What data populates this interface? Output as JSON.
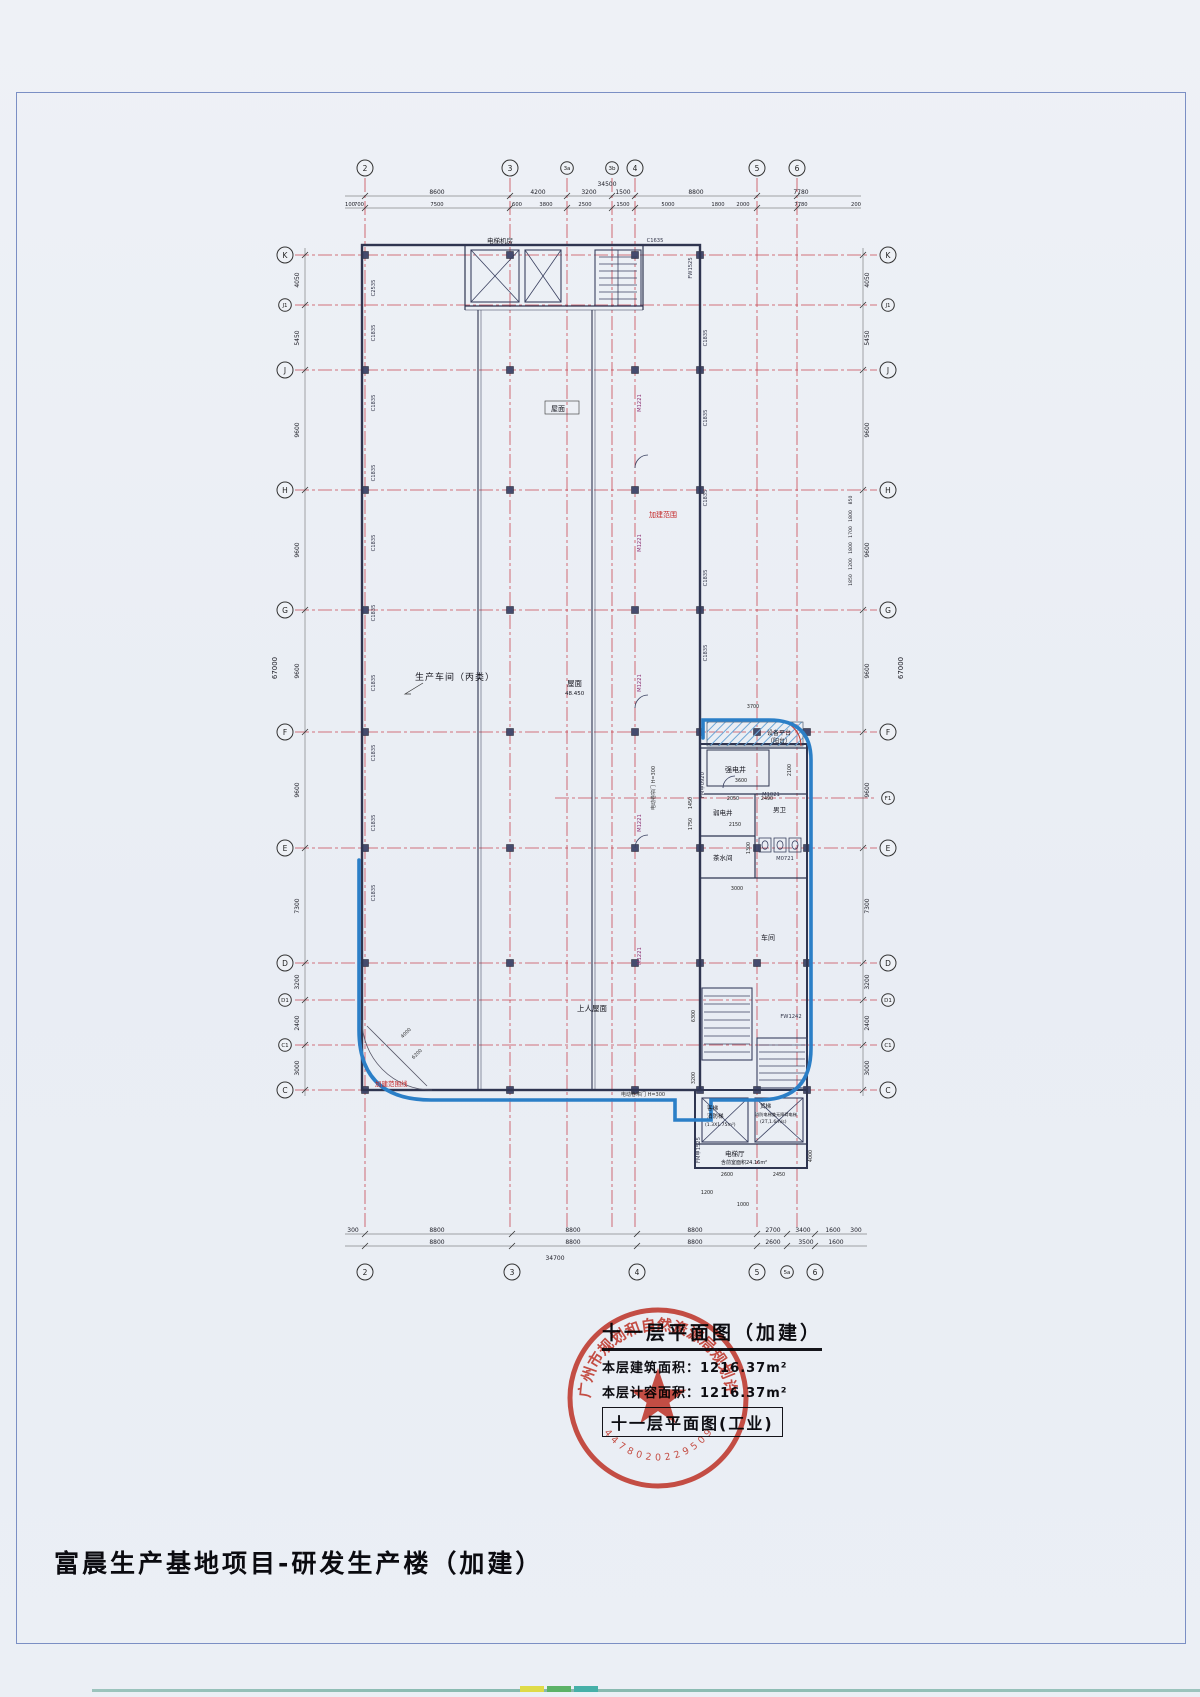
{
  "page": {
    "project_title": "富晨生产基地项目-研发生产楼（加建）"
  },
  "titleblock": {
    "drawing_title": "十一层平面图（加建）",
    "line1_label": "本层建筑面积：",
    "line1_value": "1216.37m²",
    "line2_label": "本层计容面积：",
    "line2_value": "1216.37m²",
    "boxed_title": "十一层平面图(工业)"
  },
  "stamp": {
    "ring_text": "广州市规划和自然资源局规划许可专用章",
    "serial": "4478020229509"
  },
  "grid": {
    "top": [
      "2",
      "3",
      "3a",
      "3b",
      "4",
      "5",
      "6"
    ],
    "bottom": [
      "2",
      "3",
      "4",
      "5",
      "5a",
      "6"
    ],
    "left": [
      "K",
      "J1",
      "J",
      "H",
      "G",
      "F",
      "E",
      "D",
      "D1",
      "C1",
      "C"
    ],
    "right": [
      "K",
      "J1",
      "J",
      "H",
      "G",
      "F",
      "F1",
      "E",
      "D",
      "D1",
      "C1",
      "C"
    ]
  },
  "dims": {
    "top_total": "34500",
    "top_row1": [
      "8600",
      "4200",
      "3200",
      "1500",
      "8800",
      "7780"
    ],
    "top_row2": [
      "100",
      "700",
      "7500",
      "600",
      "3800",
      "2500",
      "1500",
      "5000",
      "1800",
      "2000",
      "7780",
      "200"
    ],
    "bottom_row1": [
      "300",
      "8800",
      "8800",
      "8800",
      "2700",
      "3400",
      "1600",
      "300"
    ],
    "bottom_row2": [
      "8800",
      "8800",
      "8800",
      "2600",
      "3500",
      "1600"
    ],
    "bottom_total": "34700",
    "left_col": [
      "4050",
      "5450",
      "9600",
      "9600",
      "9600",
      "9600",
      "7300",
      "3200",
      "2400",
      "3000"
    ],
    "left_total": "67000",
    "right_col": [
      "4050",
      "5450",
      "9600",
      "9600",
      "9600",
      "9600",
      "7300",
      "3200",
      "2400",
      "3000"
    ],
    "right_total": "67000",
    "right_small": [
      "850",
      "1800",
      "1700",
      "1800",
      "1200",
      "1850"
    ]
  },
  "rooms": {
    "production": "生产车间（丙类）",
    "roof": "屋面",
    "roof_level": "48.450",
    "machine_room": "电梯机房",
    "upper_roof": "上人屋面",
    "strong_elec": "强电井",
    "weak_elec": "弱电井",
    "tea": "茶水间",
    "male_wc": "男卫",
    "equip_platform": "设备平台",
    "balcony": "（阳台）",
    "workshop": "车间",
    "pass_elevator": "客梯",
    "fire_elevator": "消防梯",
    "pass_size": "(1.3X1.75m²)",
    "freight_elevator": "货梯",
    "freight_note": "消防电梯兼无障碍电梯",
    "freight_size": "(2T,1.6m/s)",
    "elev_lobby": "电梯厅",
    "lobby_area": "含前室面积24.16m²"
  },
  "annotations": {
    "scope": "加建范围",
    "roller_door": "电动卷帘门 H=300",
    "scope_line": "加建范围线"
  },
  "tags": {
    "c1835": "C1835",
    "c1635": "C1635",
    "c2535": "C2535",
    "m1221": "M1221",
    "m1021": "M1021",
    "m0721": "M0721",
    "fm0920": "FM甲0920",
    "fm1525": "FM甲1525",
    "fw1242": "FW1242",
    "fw1525": "FW1525"
  },
  "inner_dims": [
    "3700",
    "3600",
    "2100",
    "1450",
    "1750",
    "2050",
    "2490",
    "2150",
    "1300",
    "3000",
    "6300",
    "3200",
    "2600",
    "2450",
    "4000",
    "1200",
    "1000",
    "4000",
    "6200"
  ]
}
